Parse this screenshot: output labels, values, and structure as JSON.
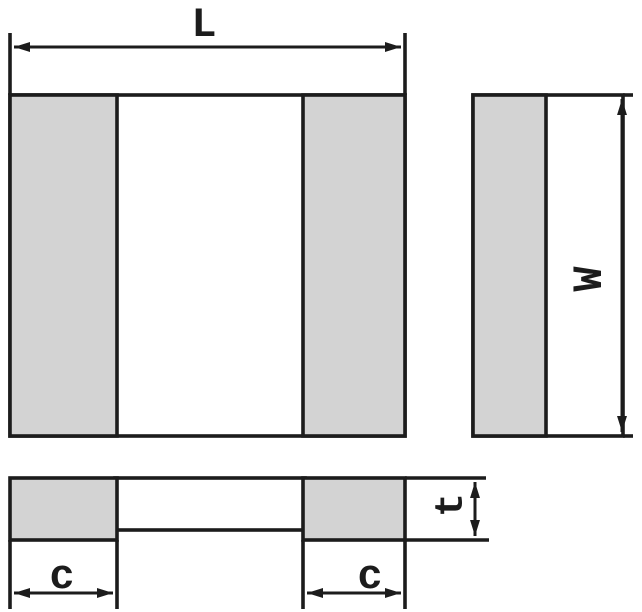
{
  "labels": {
    "length": "L",
    "width": "W",
    "thickness": "t",
    "terminal_width_left": "c",
    "terminal_width_right": "c"
  },
  "colors": {
    "outline": "#1c1c1c",
    "terminal_fill": "#d3d3d3",
    "body_fill": "#ffffff",
    "background": "#ffffff"
  }
}
